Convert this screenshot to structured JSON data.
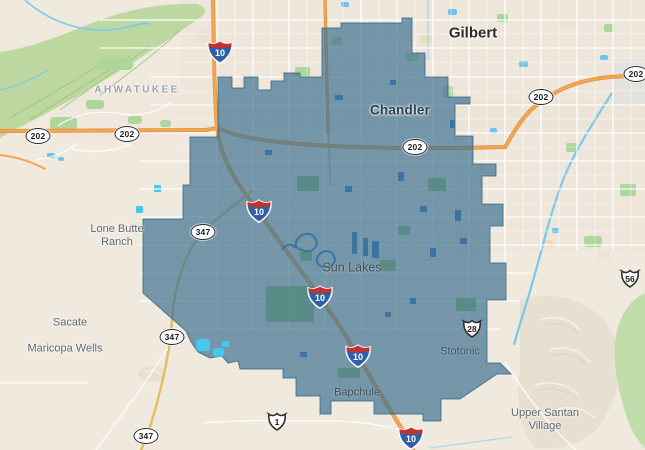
{
  "region": {
    "name": "highlighted-community-boundary",
    "fill": "#3f7292",
    "stroke": "#2e6182"
  },
  "colors": {
    "land": "#f0e9de",
    "highway_orange": "#f3a552",
    "route_yellow": "#e3bd5e",
    "water_blue": "#6fc3ea",
    "park_green": "#aed69a"
  },
  "labels": [
    {
      "id": "gilbert",
      "text": "Gilbert"
    },
    {
      "id": "chandler",
      "text": "Chandler"
    },
    {
      "id": "ahwatukee",
      "text": "AHWATUKEE"
    },
    {
      "id": "lone-butte-ranch",
      "lines": [
        "Lone Butte",
        "Ranch"
      ]
    },
    {
      "id": "sun-lakes",
      "text": "Sun Lakes"
    },
    {
      "id": "sacate",
      "text": "Sacate"
    },
    {
      "id": "maricopa-wells",
      "text": "Maricopa Wells"
    },
    {
      "id": "stotonic",
      "text": "Stotonic"
    },
    {
      "id": "bapchule",
      "text": "Bapchule"
    },
    {
      "id": "upper-santan-village",
      "lines": [
        "Upper Santan",
        "Village"
      ]
    }
  ],
  "shields": {
    "interstate": [
      {
        "num": "10"
      },
      {
        "num": "10"
      },
      {
        "num": "10"
      },
      {
        "num": "10"
      },
      {
        "num": "10"
      }
    ],
    "oval": [
      {
        "num": "202"
      },
      {
        "num": "202"
      },
      {
        "num": "202"
      },
      {
        "num": "202"
      },
      {
        "num": "202"
      },
      {
        "num": "347"
      },
      {
        "num": "347"
      },
      {
        "num": "347"
      }
    ],
    "badge": [
      {
        "num": "1"
      },
      {
        "num": "28"
      },
      {
        "num": "56"
      }
    ]
  }
}
